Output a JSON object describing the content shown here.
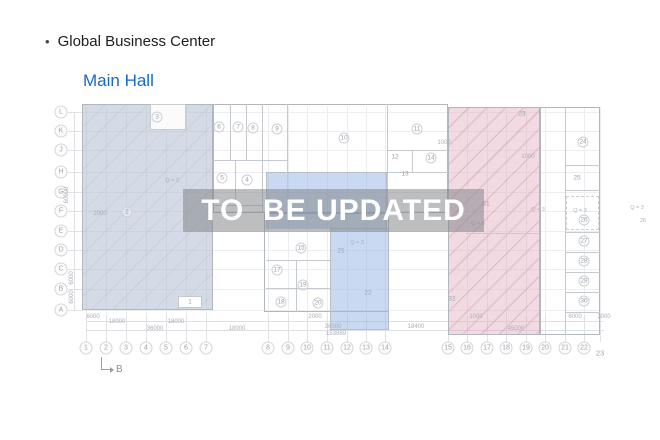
{
  "header": {
    "bullet": "•",
    "title": "Global Business Center"
  },
  "subtitle": "Main Hall",
  "watermark": "TO  BE UPDATED",
  "section_marker": "B",
  "colors": {
    "title_blue": "#1569c8",
    "zone_left": "rgba(176,190,209,0.55)",
    "zone_center": "rgba(148,180,228,0.5)",
    "zone_right": "rgba(226,172,193,0.45)",
    "watermark_bg": "rgba(128,130,134,0.52)",
    "watermark_text": "#ffffff"
  },
  "axes": {
    "rows": [
      {
        "label": "L",
        "y": 112
      },
      {
        "label": "K",
        "y": 131
      },
      {
        "label": "J",
        "y": 150
      },
      {
        "label": "H",
        "y": 172
      },
      {
        "label": "G",
        "y": 192
      },
      {
        "label": "F",
        "y": 211
      },
      {
        "label": "E",
        "y": 231
      },
      {
        "label": "D",
        "y": 250
      },
      {
        "label": "C",
        "y": 269
      },
      {
        "label": "B",
        "y": 289
      },
      {
        "label": "A",
        "y": 310
      }
    ],
    "cols": [
      {
        "label": "1",
        "x": 86
      },
      {
        "label": "2",
        "x": 106
      },
      {
        "label": "3",
        "x": 126
      },
      {
        "label": "4",
        "x": 146
      },
      {
        "label": "5",
        "x": 166
      },
      {
        "label": "6",
        "x": 186
      },
      {
        "label": "7",
        "x": 206
      },
      {
        "label": "8",
        "x": 268
      },
      {
        "label": "9",
        "x": 288
      },
      {
        "label": "10",
        "x": 307
      },
      {
        "label": "11",
        "x": 327
      },
      {
        "label": "12",
        "x": 347
      },
      {
        "label": "13",
        "x": 366
      },
      {
        "label": "14",
        "x": 385
      },
      {
        "label": "15",
        "x": 448
      },
      {
        "label": "16",
        "x": 467
      },
      {
        "label": "17",
        "x": 487
      },
      {
        "label": "18",
        "x": 506
      },
      {
        "label": "19",
        "x": 526
      },
      {
        "label": "20",
        "x": 545
      },
      {
        "label": "21",
        "x": 565
      },
      {
        "label": "22",
        "x": 584
      },
      {
        "label": "23",
        "x": 600,
        "dy": 5,
        "circle": false
      }
    ]
  },
  "rooms": [
    {
      "n": "1",
      "x": 190,
      "y": 302,
      "c": false
    },
    {
      "n": "2",
      "x": 127,
      "y": 212,
      "c": true
    },
    {
      "n": "3",
      "x": 157,
      "y": 117,
      "c": true
    },
    {
      "n": "4",
      "x": 247,
      "y": 180,
      "c": true
    },
    {
      "n": "5",
      "x": 222,
      "y": 178,
      "c": true
    },
    {
      "n": "6",
      "x": 219,
      "y": 127,
      "c": true
    },
    {
      "n": "7",
      "x": 238,
      "y": 127,
      "c": true
    },
    {
      "n": "8",
      "x": 253,
      "y": 128,
      "c": true
    },
    {
      "n": "9",
      "x": 277,
      "y": 129,
      "c": true
    },
    {
      "n": "10",
      "x": 344,
      "y": 138,
      "c": true
    },
    {
      "n": "11",
      "x": 417,
      "y": 129,
      "c": true
    },
    {
      "n": "12",
      "x": 395,
      "y": 157,
      "c": false
    },
    {
      "n": "13",
      "x": 405,
      "y": 174,
      "c": false
    },
    {
      "n": "14",
      "x": 431,
      "y": 158,
      "c": true
    },
    {
      "n": "15",
      "x": 301,
      "y": 248,
      "c": true
    },
    {
      "n": "17",
      "x": 277,
      "y": 270,
      "c": true
    },
    {
      "n": "18",
      "x": 281,
      "y": 302,
      "c": true
    },
    {
      "n": "19",
      "x": 303,
      "y": 285,
      "c": true
    },
    {
      "n": "20",
      "x": 318,
      "y": 303,
      "c": true
    },
    {
      "n": "21",
      "x": 341,
      "y": 251,
      "c": false
    },
    {
      "n": "22",
      "x": 368,
      "y": 293,
      "c": false
    },
    {
      "n": "23",
      "x": 522,
      "y": 114,
      "c": false
    },
    {
      "n": "24",
      "x": 583,
      "y": 142,
      "c": true
    },
    {
      "n": "25",
      "x": 577,
      "y": 178,
      "c": false
    },
    {
      "n": "26",
      "x": 584,
      "y": 220,
      "c": true
    },
    {
      "n": "27",
      "x": 584,
      "y": 241,
      "c": true
    },
    {
      "n": "28",
      "x": 584,
      "y": 261,
      "c": true
    },
    {
      "n": "29",
      "x": 584,
      "y": 281,
      "c": true
    },
    {
      "n": "30",
      "x": 584,
      "y": 301,
      "c": true
    },
    {
      "n": "31",
      "x": 486,
      "y": 204,
      "c": false
    },
    {
      "n": "32",
      "x": 452,
      "y": 299,
      "c": false
    }
  ],
  "annotations": [
    {
      "t": "Q = 3",
      "x": 172,
      "y": 181
    },
    {
      "t": "Q = 3",
      "x": 357,
      "y": 243
    },
    {
      "t": "Q = 3",
      "x": 478,
      "y": 224
    },
    {
      "t": "Q = 3",
      "x": 538,
      "y": 210
    },
    {
      "t": "Q = 3",
      "x": 580,
      "y": 211
    },
    {
      "t": "Q = 3",
      "x": 637,
      "y": 208
    },
    {
      "t": "26",
      "x": 643,
      "y": 221
    }
  ],
  "dimensions": [
    {
      "t": "6000",
      "x": 93,
      "y": 317
    },
    {
      "t": "18000",
      "x": 117,
      "y": 322
    },
    {
      "t": "18000",
      "x": 176,
      "y": 322
    },
    {
      "t": "36000",
      "x": 155,
      "y": 329
    },
    {
      "t": "18000",
      "x": 237,
      "y": 329
    },
    {
      "t": "2000",
      "x": 315,
      "y": 317
    },
    {
      "t": "36000",
      "x": 333,
      "y": 327
    },
    {
      "t": "153869",
      "x": 336,
      "y": 334
    },
    {
      "t": "18400",
      "x": 416,
      "y": 327
    },
    {
      "t": "1000",
      "x": 476,
      "y": 317
    },
    {
      "t": "45000",
      "x": 516,
      "y": 329
    },
    {
      "t": "6000",
      "x": 575,
      "y": 317
    },
    {
      "t": "3000",
      "x": 604,
      "y": 317
    },
    {
      "t": "1000",
      "x": 444,
      "y": 143
    },
    {
      "t": "1000",
      "x": 528,
      "y": 157
    },
    {
      "t": "2000",
      "x": 100,
      "y": 214
    },
    {
      "t": "60000",
      "x": 67,
      "y": 195,
      "v": true
    },
    {
      "t": "6000",
      "x": 72,
      "y": 278,
      "v": true
    },
    {
      "t": "6000",
      "x": 72,
      "y": 297,
      "v": true
    }
  ]
}
